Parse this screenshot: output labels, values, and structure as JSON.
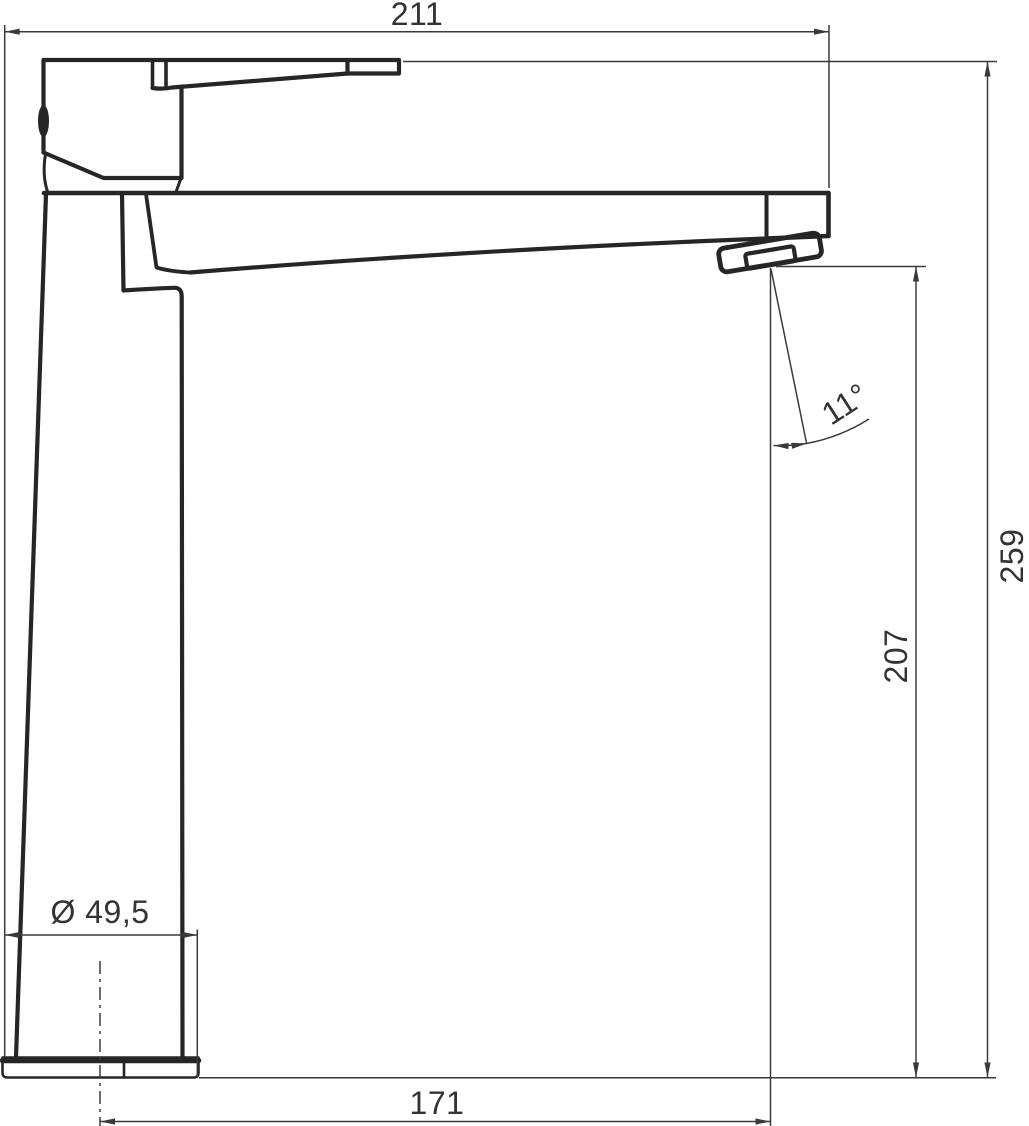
{
  "dimensions": {
    "overall_length": {
      "label": "211"
    },
    "overall_height": {
      "label": "259"
    },
    "outlet_height": {
      "label": "207"
    },
    "outlet_angle": {
      "label": "11°"
    },
    "base_diameter": {
      "label": "Ø 49,5"
    },
    "outlet_reach": {
      "label": "171"
    }
  },
  "colors": {
    "background": "#ffffff",
    "faucet_outline": "#262626",
    "dimension_lines": "#3a3a3a",
    "label_text": "#333333"
  }
}
